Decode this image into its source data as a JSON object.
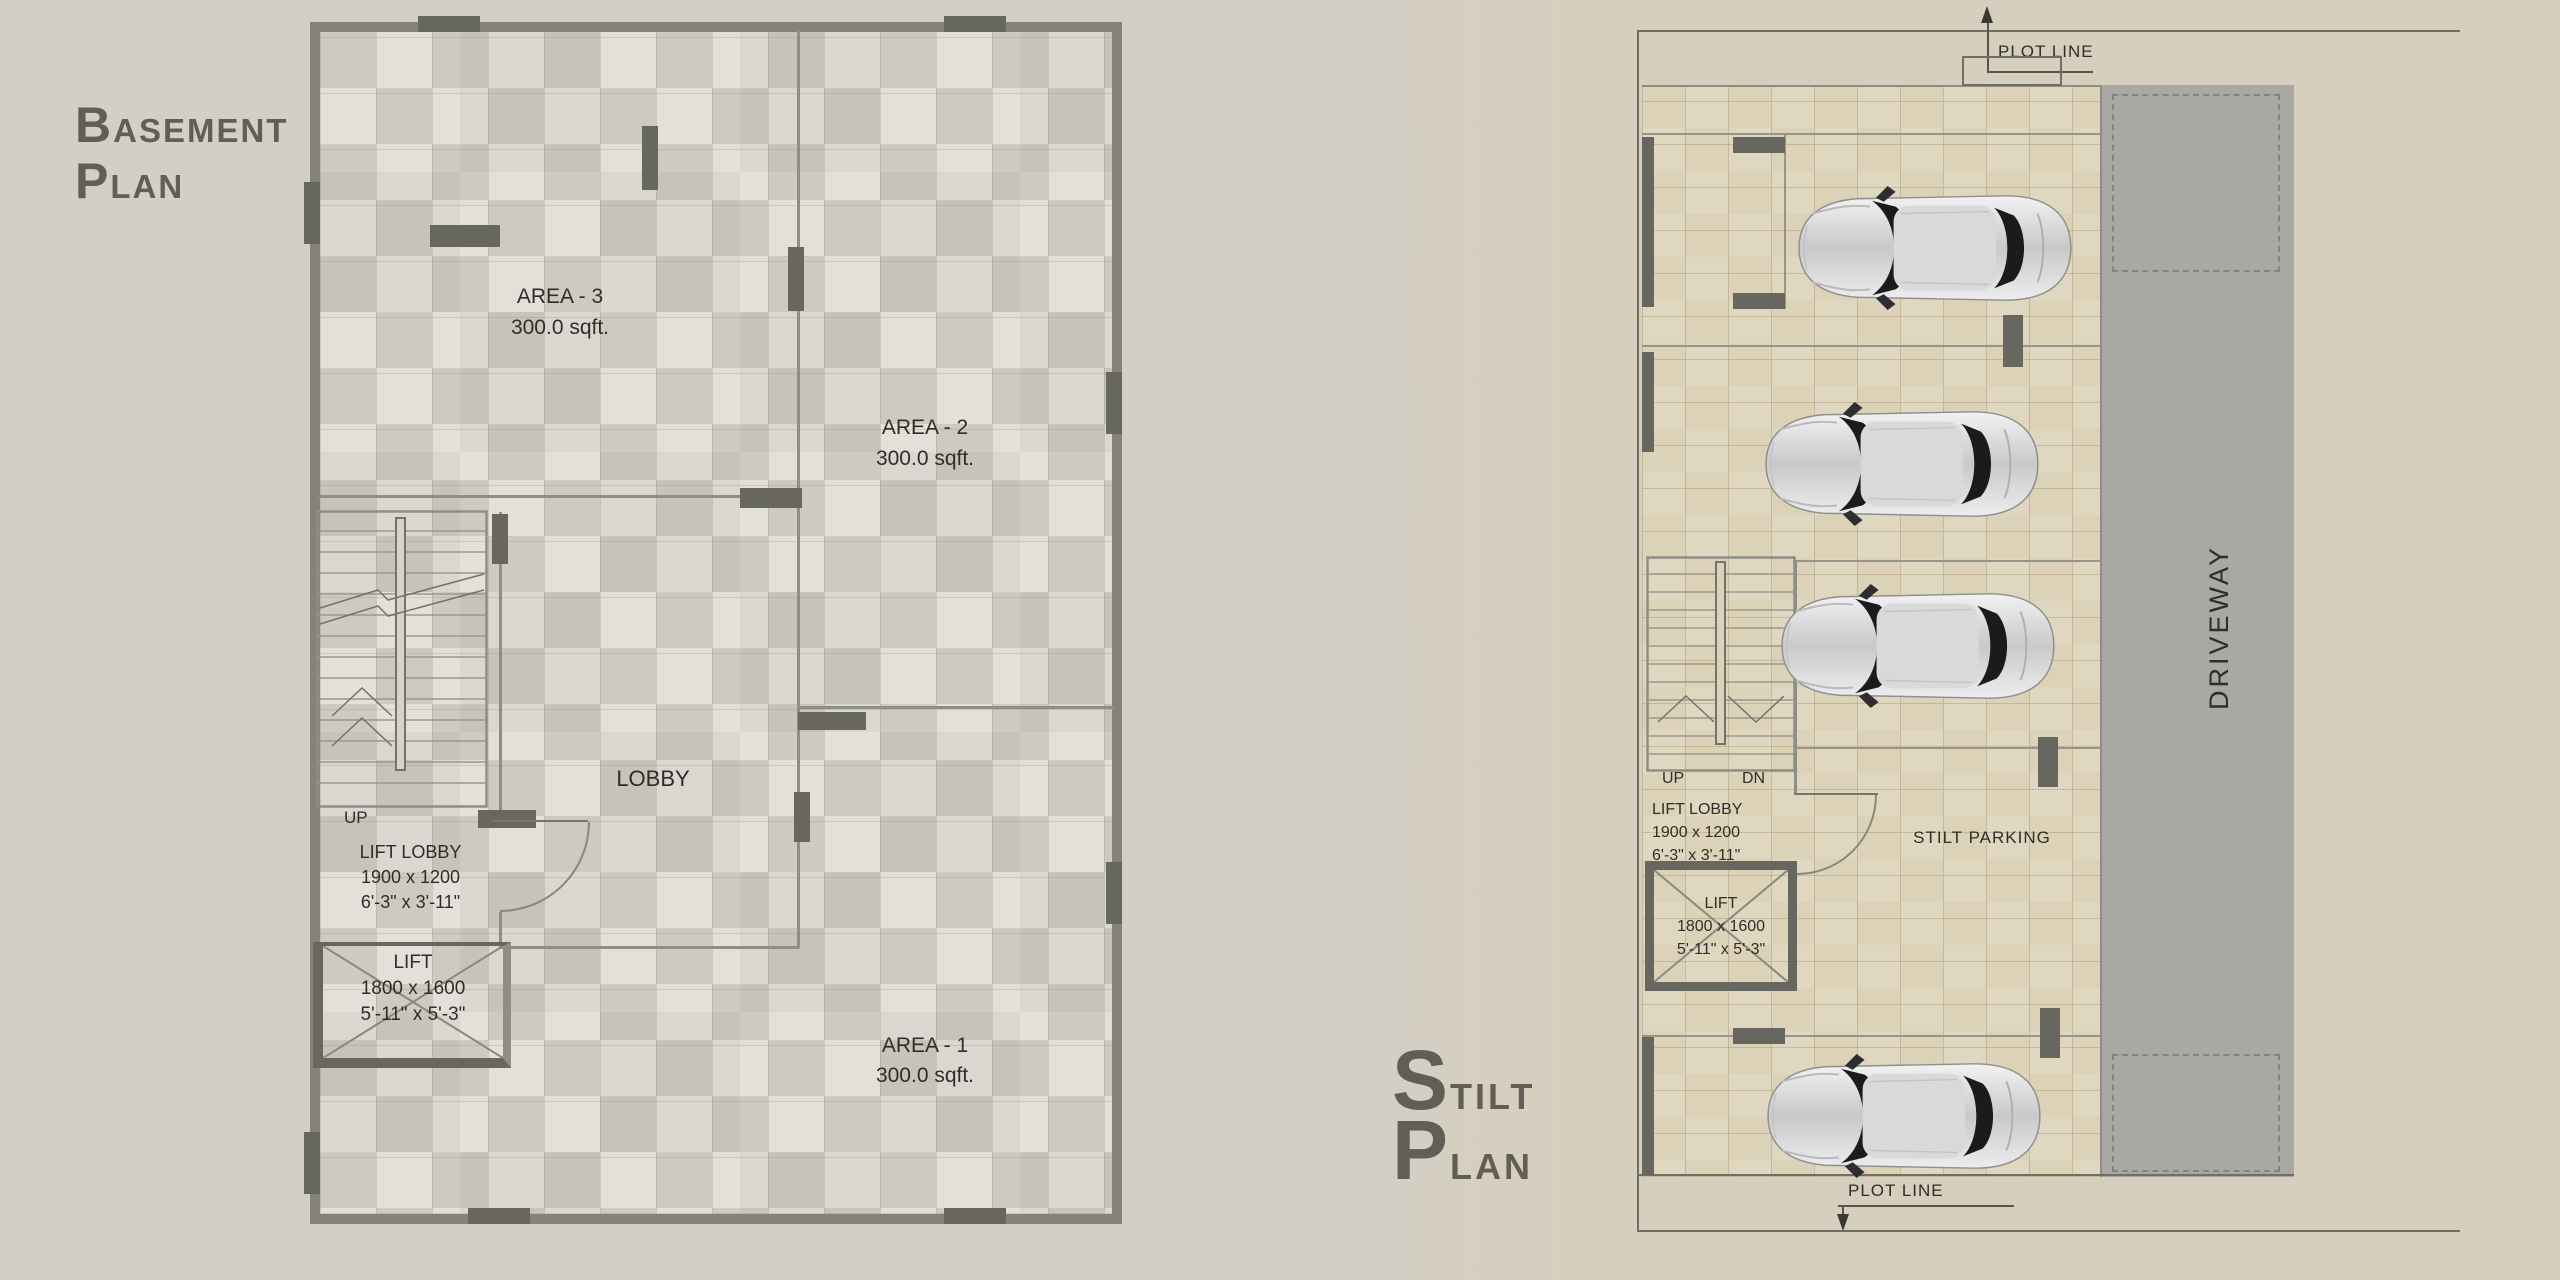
{
  "colors": {
    "background_left": "#d3cfc7",
    "background_right": "#d7cfbe",
    "basement_floor": "#d7d4cb",
    "stilt_floor": "#dcd2b8",
    "driveway": "#a9a8a3",
    "wall_dark": "#67665f",
    "wall_medium": "#84837b",
    "title_text": "#605e56",
    "label_text": "#2f2d28",
    "car_body": "#e4e4e6",
    "car_glass": "#1b1b1e"
  },
  "basement": {
    "title": {
      "l1_big": "B",
      "l1_rest": "ASEMENT",
      "l2_big": "P",
      "l2_rest": "LAN"
    },
    "areas": [
      {
        "name": "AREA - 3",
        "size": "300.0 sqft."
      },
      {
        "name": "AREA - 2",
        "size": "300.0 sqft."
      },
      {
        "name": "AREA - 1",
        "size": "300.0 sqft."
      }
    ],
    "lobby_label": "LOBBY",
    "stairs_up_label": "UP",
    "lift_lobby": {
      "label": "LIFT LOBBY",
      "dim_mm": "1900 x 1200",
      "dim_ft": "6'-3\" x 3'-11\""
    },
    "lift": {
      "label": "LIFT",
      "dim_mm": "1800 x 1600",
      "dim_ft": "5'-11\" x 5'-3\""
    }
  },
  "stilt": {
    "title": {
      "l1_big": "S",
      "l1_rest": "TILT",
      "l2_big": "P",
      "l2_rest": "LAN"
    },
    "plot_line_top": "PLOT LINE",
    "plot_line_bottom": "PLOT LINE",
    "driveway_label": "DRIVEWAY",
    "parking_label": "STILT PARKING",
    "stairs_up_label": "UP",
    "stairs_dn_label": "DN",
    "lift_lobby": {
      "label": "LIFT LOBBY",
      "dim_mm": "1900 x 1200",
      "dim_ft": "6'-3\" x 3'-11\""
    },
    "lift": {
      "label": "LIFT",
      "dim_mm": "1800 x 1600",
      "dim_ft": "5'-11\" x 5'-3\""
    },
    "car_count": 4
  }
}
